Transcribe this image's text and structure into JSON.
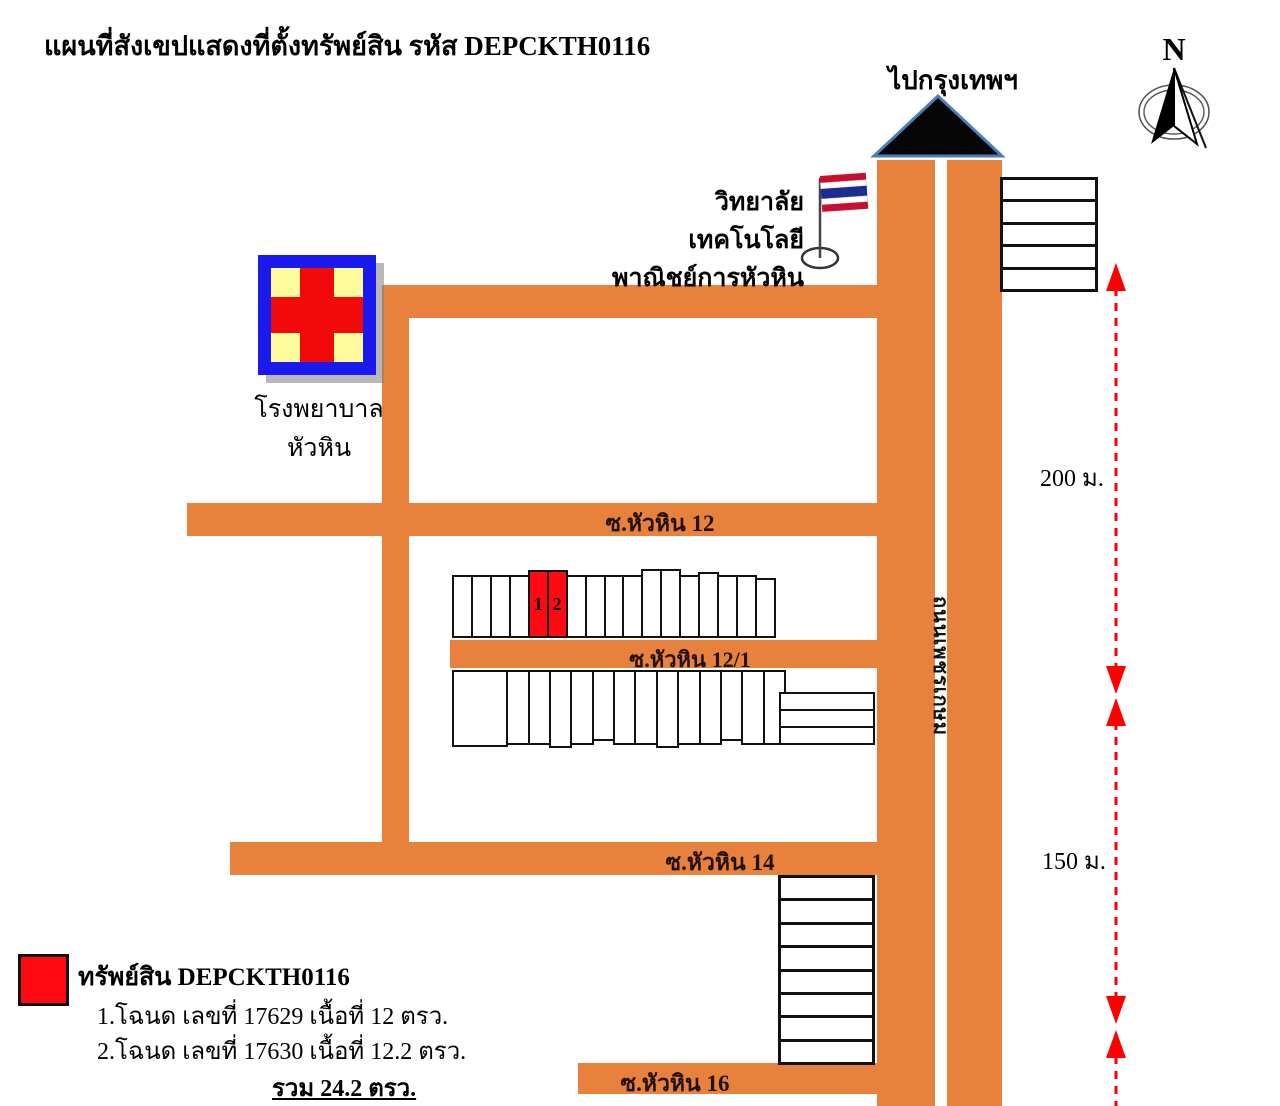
{
  "title": "แผนที่สังเขปแสดงที่ตั้งทรัพย์สิน รหัส DEPCKTH0116",
  "compass": {
    "north_label": "N"
  },
  "to_bangkok_label": "ไปกรุงเทพฯ",
  "landmarks": {
    "college": {
      "name_line1": "วิทยาลัยเทคโนโลยี",
      "name_line2": "พาณิชย์การหัวหิน"
    },
    "hospital": {
      "name_line1": "โรงพยาบาล",
      "name_line2": "หัวหิน"
    }
  },
  "roads": {
    "main_road": "ถนนเพชรเกษม",
    "soi_12": "ซ.หัวหิน 12",
    "soi_12_1": "ซ.หัวหิน 12/1",
    "soi_14": "ซ.หัวหิน 14",
    "soi_16": "ซ.หัวหิน 16"
  },
  "property": {
    "unit_1": "1",
    "unit_2": "2"
  },
  "distances": {
    "north_segment": "200 ม.",
    "south_segment": "150 ม."
  },
  "legend": {
    "title": "ทรัพย์สิน DEPCKTH0116",
    "items": [
      "1.โฉนด เลขที่ 17629 เนื้อที่ 12 ตรว.",
      "2.โฉนด เลขที่ 17630 เนื้อที่ 12.2 ตรว."
    ],
    "total": "รวม 24.2 ตรว."
  },
  "colors": {
    "road_orange": "#E8813C",
    "property_red": "#FF0A12",
    "arrow_red": "#FF0000",
    "triangle_fill": "#050505",
    "triangle_border": "#4A7EBB",
    "hospital_blue": "#1A1AEF",
    "hospital_yellow": "#FFFB9D",
    "hospital_cross_red": "#F20A0A"
  }
}
